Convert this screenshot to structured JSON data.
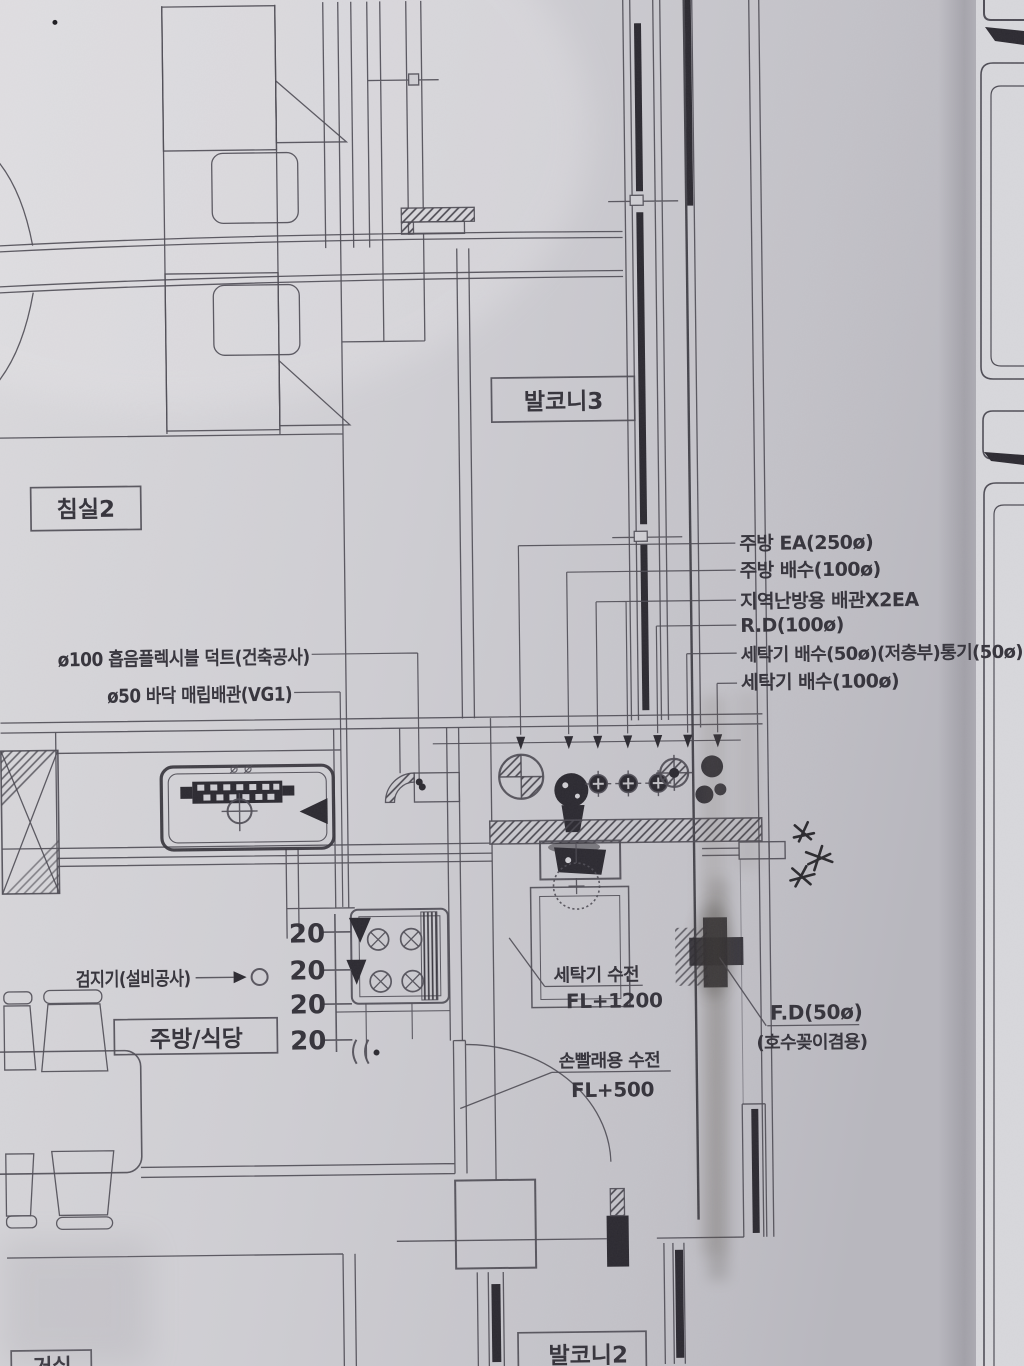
{
  "drawing": {
    "rooms": {
      "balcony3": "발코니3",
      "bedroom2": "침실2",
      "kitchen_dining": "주방/식당",
      "balcony2": "발코니2",
      "living": "거실"
    },
    "callouts_right": [
      "주방 EA(250ø)",
      "주방 배수(100ø)",
      "지역난방용 배관X2EA",
      "R.D(100ø)",
      "세탁기 배수(50ø)(저층부)통기(50ø)",
      "세탁기 배수(100ø)"
    ],
    "callouts_left": [
      "ø100 흡음플렉시블 덕트(건축공사)",
      "ø50 바닥 매립배관(VG1)"
    ],
    "detector_label": "검지기(설비공사)",
    "washer_faucet": {
      "label": "세탁기 수전",
      "level": "FL+1200"
    },
    "hand_faucet": {
      "label": "손빨래용 수전",
      "level": "FL+500"
    },
    "floor_drain": {
      "label": "F.D(50ø)",
      "note": "(호수꽂이겸용)"
    },
    "dims": [
      "20",
      "20",
      "20",
      "20"
    ],
    "colors": {
      "paper": "#cfced3",
      "ink": "#4e4c55",
      "dark": "#2b2930"
    }
  }
}
